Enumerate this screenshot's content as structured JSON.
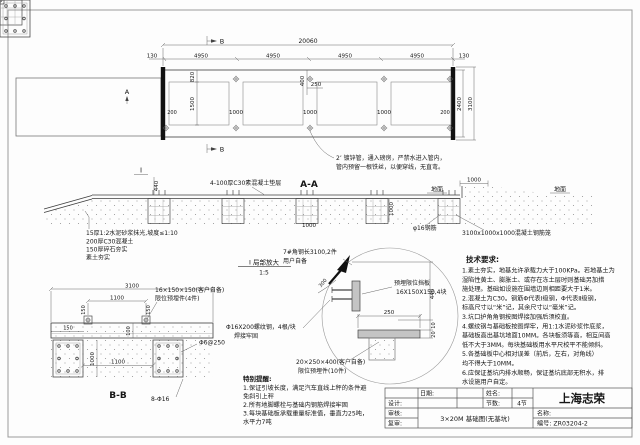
{
  "colors": {
    "line": "#3c3c3c",
    "thin": "#8a8a8a",
    "dim": "#555555",
    "steel_fill": "#c4c4c4",
    "rail": "#111111",
    "border": "#9a9a9a"
  },
  "plan": {
    "marker_a": "A",
    "marker_b": "B",
    "dim_total": "20060",
    "dim_130": "130",
    "dim_4950": "4950",
    "dim_820": "820",
    "dim_1500": "1500",
    "dim_400": "400",
    "dim_250": "250",
    "dim_1000": "1000",
    "dim_200": "200",
    "dim_2400": "2400",
    "dim_3100": "3100",
    "pipe_note1": "2’ 镀锌管，通入磅房，严禁水进入管内，",
    "pipe_note2": "管内预留一根铁丝，以便穿线，无直弯。"
  },
  "section_aa": {
    "title": "A-A",
    "cushion": "4-100厚C30素混凝土垫层",
    "ground": "地面",
    "dim_1000": "1000",
    "dim_440": "440",
    "flag": "I",
    "rebar": "φ16钢筋",
    "cage": "3100x1000x1000混凝土钢筋笼",
    "note1": "15厚1:2水泥砂浆抹光,坡度≤1:10",
    "note2": "200厚C30混凝土",
    "note3": "150厚碎石夯实",
    "note4": "素土夯实"
  },
  "detail_i": {
    "title": "I 局部放大",
    "scale": "1:5",
    "angle1": "7#角钢长3100,2件",
    "angle2": "用户自备",
    "dim_300": "300",
    "plate1": "预埋限位挡板",
    "plate2": "16X150X150,4块",
    "dim_250": "250",
    "dim_440": "440",
    "dim_10": "10",
    "dim_20": "20",
    "rod1": "Φ16X200螺纹钢，4根/块",
    "rod2": "焊接牢固",
    "embed1": "20×250×400(客户自备)",
    "embed2": "限位预埋件(10件)"
  },
  "section_bb": {
    "title": "B-B",
    "dim_3100": "3100",
    "dim_1100": "1100",
    "dim_150": "150",
    "dim_100": "100",
    "dim_1000": "1000",
    "plate1": "16×150×150(客户自备)",
    "plate2": "限位预埋件(4件)",
    "stirrup": "Φ6@250",
    "rebar": "8-Φ16"
  },
  "special": {
    "title": "特别提醒:",
    "lines": [
      "1.保证引坡长度，满足汽车直线上秤的条件避",
      "免斜引上秤",
      "2.所有地脚螺栓与基础内钢筋焊接牢固",
      "3.每块基础板承载重量标准值，垂直力25吨，",
      "水平力7吨"
    ]
  },
  "tech": {
    "title": "技术要求:",
    "lines": [
      "1.素土夯实，地基允许承载力大于100KPa。若地基土为",
      "湿陷性黄土、膨胀土、或存在冻土层时则基础另加措",
      "施处理。基础如设施在围墙边则相距要大于1米。",
      "2.混凝土为C30。钢筋Φ代表Ⅰ级钢，Φ代表Ⅱ级钢，",
      "标高尺寸以“米”记，其余尺寸以“毫米”记。",
      "3.坑口护角角钢按图焊接加强后须校直。",
      "4.螺纹钢与基础板按图焊牢，用1:1水泥砂浆作底浆，",
      "基础板高出基坑地面10MM。各块板须等高，相互间高",
      "低不大于3MM。每块基础板用水平尺校平不能倾斜。",
      "5.各基础板中心相对误差（前后，左右，对角线）",
      "均不得大于10MM。",
      "6.应保证基坑内排水顺畅，保证基坑底部无积水，排",
      "水设施用户自定。"
    ]
  },
  "titleblock": {
    "company": "上海志荣",
    "date_label": "日期:",
    "name_label": "姓名:",
    "design_label": "设计:",
    "sections_label": "节数:",
    "sections_value": "4节",
    "check_label": "审核:",
    "review_label": "复审:",
    "drawing_title": "3×20M 基础图(无基坑)",
    "name_title_label": "名称:",
    "number_label": "编号: ZR03204-2"
  }
}
